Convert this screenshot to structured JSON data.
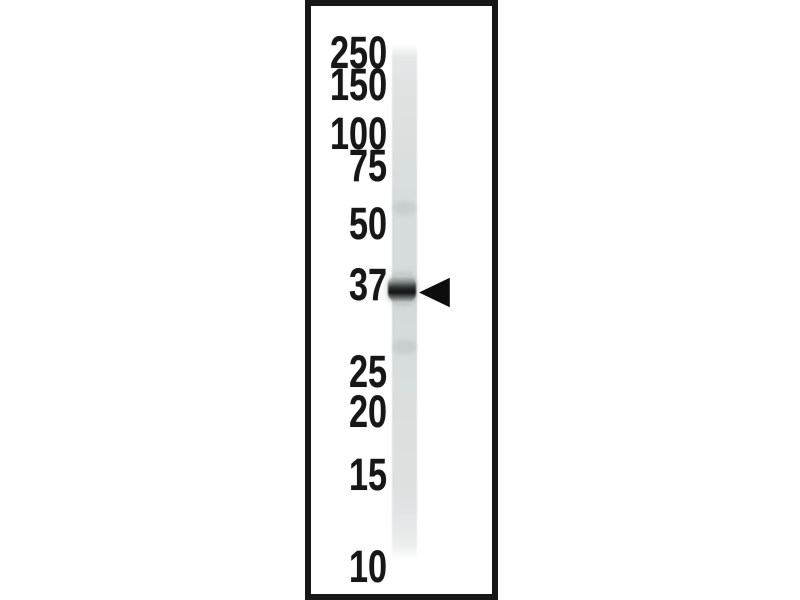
{
  "blot": {
    "description": "western blot single lane with molecular weight ladder labels and arrowhead marking a band",
    "markers": [
      {
        "label": "250",
        "y": 51
      },
      {
        "label": "150",
        "y": 83
      },
      {
        "label": "100",
        "y": 132
      },
      {
        "label": "75",
        "y": 164
      },
      {
        "label": "50",
        "y": 222
      },
      {
        "label": "37",
        "y": 283
      },
      {
        "label": "25",
        "y": 370
      },
      {
        "label": "20",
        "y": 410
      },
      {
        "label": "15",
        "y": 473
      },
      {
        "label": "10",
        "y": 565
      }
    ],
    "band": {
      "y": 289,
      "nearest_marker_label": "37",
      "arrow_direction": "left"
    },
    "faint_bands": [
      {
        "y": 208
      },
      {
        "y": 347
      }
    ],
    "colors": {
      "page_background": "#ffffff",
      "frame_border": "#171717",
      "lane_base": "#d9dedd",
      "band_dark": "#0f1110",
      "label_text": "#171717",
      "arrow_fill": "#0d0d0d"
    }
  }
}
